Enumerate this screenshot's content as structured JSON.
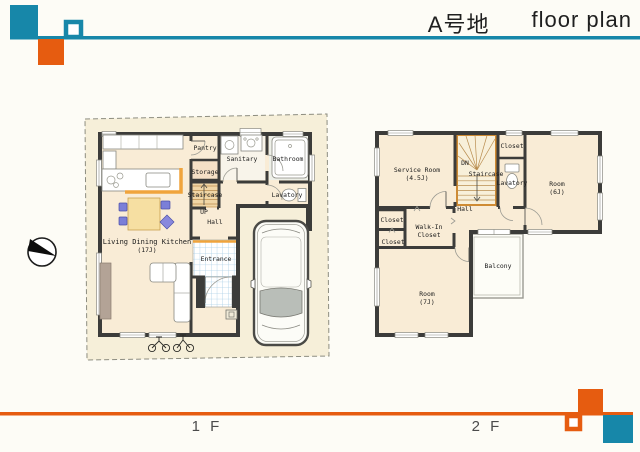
{
  "header": {
    "title_jp": "A号地",
    "title_en": "floor plan"
  },
  "icons": {
    "compass": "north-direction-compass"
  },
  "colors": {
    "teal": "#1787a9",
    "orange": "#e65c10",
    "wall": "#3c3c3a",
    "floor": "#f9ecd6",
    "stair": "#f0d6a6",
    "counter": "#f0a43c",
    "tile_line": "#abcfe6",
    "boundary_fill": "#f6efd9"
  },
  "floor1": {
    "label": "1 F",
    "rooms": {
      "ldk_name": "Living Dining Kitchen",
      "ldk_size": "(17J)",
      "pantry": "Pantry",
      "sanitary": "Sanitary",
      "bathroom": "Bathroom",
      "storage": "Storage",
      "staircase": "Staircase",
      "up": "UP",
      "lavatory": "Lavatory",
      "hall": "Hall",
      "entrance": "Entrance"
    }
  },
  "floor2": {
    "label": "2 F",
    "rooms": {
      "service_name": "Service Room",
      "service_size": "(4.5J)",
      "dn": "DN",
      "staircase": "Staircase",
      "closet_top": "Closet",
      "lavatory": "Lavatory",
      "room6_name": "Room",
      "room6_size": "(6J)",
      "hall": "Hall",
      "closet_mid": "Closet",
      "walkin_line1": "Walk-In",
      "walkin_line2": "Closet",
      "closet_low": "Closet",
      "room7_name": "Room",
      "room7_size": "(7J)",
      "balcony": "Balcony"
    }
  }
}
